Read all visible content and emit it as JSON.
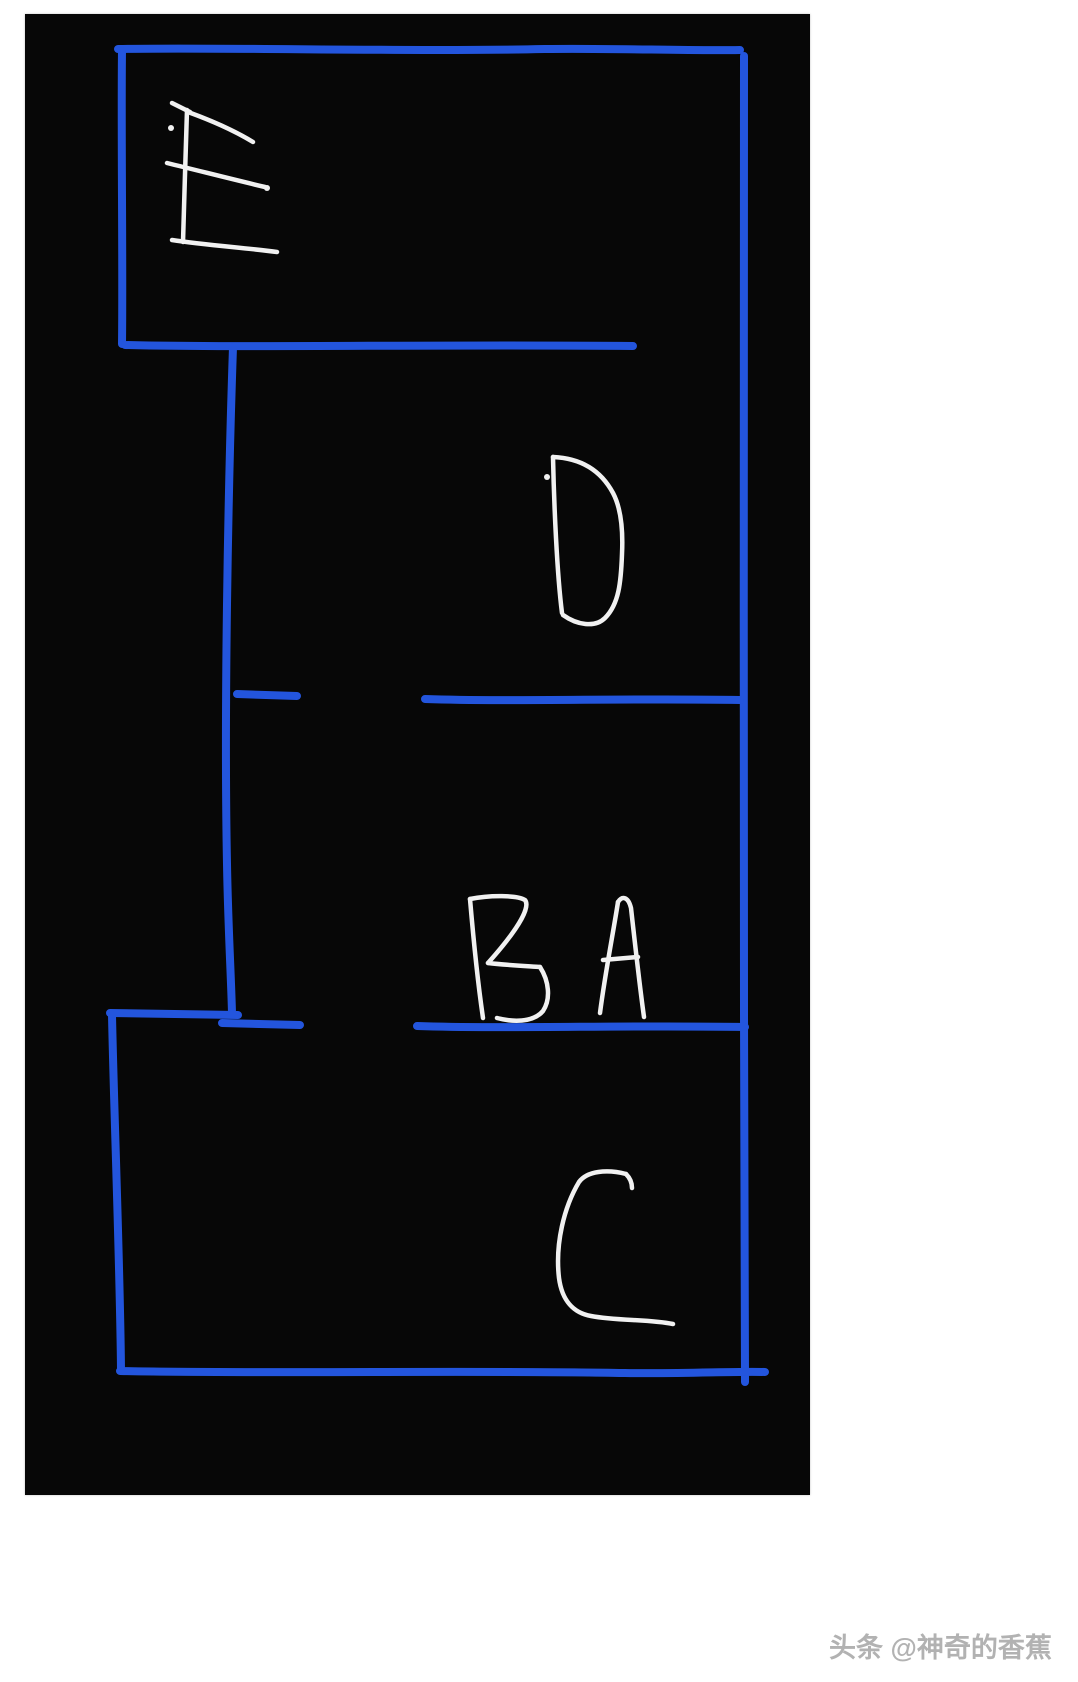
{
  "canvas": {
    "x": 25,
    "y": 14,
    "width": 785,
    "height": 1481,
    "background": "#070707"
  },
  "colors": {
    "wall": "#2355dd",
    "letter": "#f1f1f1"
  },
  "watermark": {
    "text": "头条 @神奇的香蕉",
    "color": "#b2b2b2"
  },
  "sketch": {
    "wall_width": 8,
    "letter_width": 4.5,
    "dot_radius": 3,
    "walls": [
      {
        "name": "outer-top-wall",
        "d": "M93,35 C200,33 380,38 520,35 C590,34 660,37 715,36"
      },
      {
        "name": "outer-right-wall",
        "d": "M719,42 C721,300 717,700 719,1000 C720,1150 719,1290 720,1368"
      },
      {
        "name": "outer-bottom-wall",
        "d": "M95,1357 C250,1360 450,1356 600,1359 C660,1360 710,1357 740,1358"
      },
      {
        "name": "bottom-room-left-wall",
        "d": "M87,1001 C89,1100 95,1250 96,1356"
      },
      {
        "name": "e-room-left-wall",
        "d": "M97,37 C96,120 98,250 97,330"
      },
      {
        "name": "e-room-bottom-wall",
        "d": "M100,331 C220,334 420,330 608,332"
      },
      {
        "name": "middle-vertical-wall",
        "d": "M208,333 C203,480 199,700 202,850 C203,910 206,960 207,999"
      },
      {
        "name": "middle-wall-left-segment",
        "d": "M212,680 L272,682"
      },
      {
        "name": "middle-wall-right-segment",
        "d": "M400,685 C490,688 600,684 715,686"
      },
      {
        "name": "bottom-room-top-wall-left",
        "d": "M85,999 L213,1001"
      },
      {
        "name": "bottom-room-top-wall-left2",
        "d": "M197,1009 L275,1011"
      },
      {
        "name": "bottom-room-top-wall-right",
        "d": "M392,1012 C480,1015 600,1011 720,1013"
      }
    ],
    "letters": [
      {
        "label": "E",
        "strokes": [
          "M147,89 L165,98",
          "M162,96 C161,130 159,190 158,228",
          "M163,98 C185,106 210,117 228,128",
          "M142,149 C175,157 210,166 240,173",
          "M147,226 C180,231 222,234 252,238"
        ]
      },
      {
        "label": "D",
        "strokes": [
          "M528,443 C529,490 532,560 537,599",
          "M528,443 C552,444 574,453 588,479 C597,496 598,519 597,540 C596,568 594,590 580,604 C570,614 552,611 538,601"
        ]
      },
      {
        "label": "B",
        "strokes": [
          "M445,885 C448,920 453,970 458,1004",
          "M445,885 C465,881 492,881 500,886 C505,892 497,911 463,949",
          "M463,949 C480,951 500,952 515,953",
          "M515,953 C524,967 526,985 518,997 C508,1009 487,1008 472,1004"
        ]
      },
      {
        "label": "A",
        "strokes": [
          "M575,999 C580,960 588,920 593,888",
          "M593,888 C597,882 603,882 606,894 C610,930 615,975 619,1003",
          "M578,946 L613,943"
        ]
      },
      {
        "label": "C",
        "strokes": [
          "M601,1160 C606,1165 607,1170 607,1174",
          "M601,1160 C582,1155 562,1157 554,1168 C539,1193 530,1230 534,1264 C537,1287 549,1299 566,1302 C592,1307 624,1305 648,1310"
        ]
      }
    ],
    "dots": [
      {
        "name": "e-dot",
        "x": 146,
        "y": 114
      },
      {
        "name": "e-mid-arm-dot",
        "x": 242,
        "y": 174
      },
      {
        "name": "d-dot",
        "x": 522,
        "y": 463
      }
    ]
  }
}
